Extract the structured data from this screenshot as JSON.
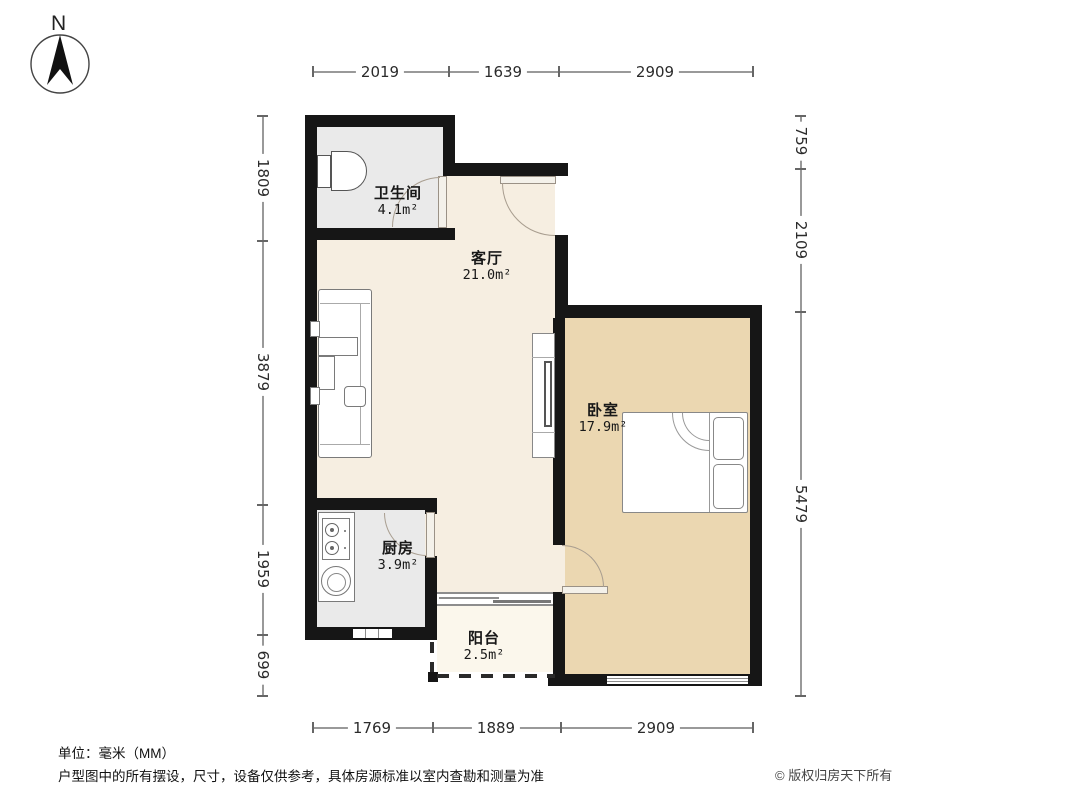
{
  "north_label": "N",
  "rooms": [
    {
      "name": "卫生间",
      "area": "4.1m²"
    },
    {
      "name": "客厅",
      "area": "21.0m²"
    },
    {
      "name": "卧室",
      "area": "17.9m²"
    },
    {
      "name": "厨房",
      "area": "3.9m²"
    },
    {
      "name": "阳台",
      "area": "2.5m²"
    }
  ],
  "dimensions_mm": {
    "top": [
      "2019",
      "1639",
      "2909"
    ],
    "bottom": [
      "1769",
      "1889",
      "2909"
    ],
    "left": [
      "1809",
      "3879",
      "1959",
      "699"
    ],
    "right": [
      "759",
      "2109",
      "5479"
    ]
  },
  "footer": {
    "unit_note": "单位：毫米（MM）",
    "disclaimer": "户型图中的所有摆设，尺寸，设备仅供参考，具体房源标准以室内查勘和测量为准",
    "copyright": "© 版权归房天下所有"
  },
  "colors": {
    "wall": "#161616",
    "living_floor": "#f6eee1",
    "bedroom_floor": "#ebd7b1",
    "service_floor": "#eaeaea",
    "balcony_floor": "#fbf7ec"
  }
}
